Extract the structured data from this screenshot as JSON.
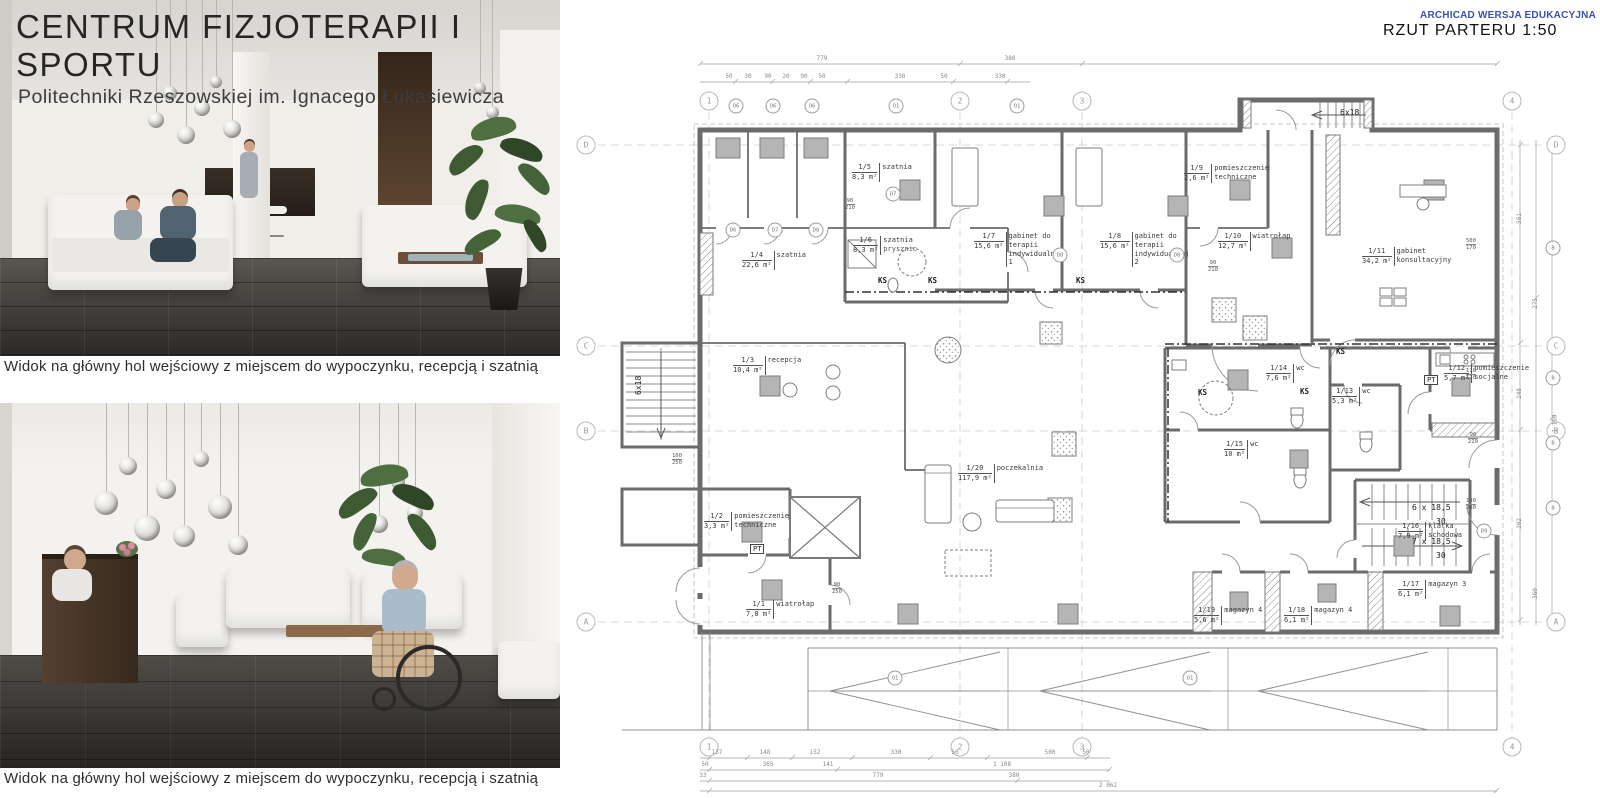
{
  "board": {
    "title": "CENTRUM  FIZJOTERAPII I SPORTU",
    "subtitle": "Politechniki Rzeszowskiej im. Ignacego Łukasiewicza",
    "caption_top": "Widok  na główny hol  wejściowy z miejscem do wypoczynku, recepcją i szatnią",
    "caption_bottom": "Widok na główny hol wejściowy z miejscem do wypoczynku, recepcją i szatnią"
  },
  "plan": {
    "watermark": "ARCHICAD WERSJA EDUKACYJNA",
    "accent_blue": "#3d52a5",
    "title": "RZUT PARTERU 1:50",
    "room_sub": "prysznic",
    "rooms": [
      {
        "id": "1/1",
        "area": "7,8 m²",
        "name": "wiatrołap"
      },
      {
        "id": "1/2",
        "area": "3,3 m²",
        "name": "pomieszczenie techniczne"
      },
      {
        "id": "1/3",
        "area": "10,4 m²",
        "name": "recepcja"
      },
      {
        "id": "1/4",
        "area": "22,6 m²",
        "name": "szatnia"
      },
      {
        "id": "1/5",
        "area": "8,3 m²",
        "name": "szatnia"
      },
      {
        "id": "1/6",
        "area": "8,3 m²",
        "name": "szatnia"
      },
      {
        "id": "1/7",
        "area": "15,6 m²",
        "name": "gabinet do terapii indywidualnej 1"
      },
      {
        "id": "1/8",
        "area": "15,6 m²",
        "name": "gabinet do terapii indywidualnej 2"
      },
      {
        "id": "1/9",
        "area": "2,6 m²",
        "name": "pomieszczenie techniczne"
      },
      {
        "id": "1/10",
        "area": "12,7 m²",
        "name": "wiatrołap"
      },
      {
        "id": "1/11",
        "area": "34,2 m²",
        "name": "gabinet konsultacyjny"
      },
      {
        "id": "1/12",
        "area": "5,7 m²",
        "name": "pomieszczenie socjalne"
      },
      {
        "id": "1/13",
        "area": "5,3 m²",
        "name": "wc"
      },
      {
        "id": "1/14",
        "area": "7,6 m²",
        "name": "wc"
      },
      {
        "id": "1/15",
        "area": "10 m²",
        "name": "wc"
      },
      {
        "id": "1/16",
        "area": "7,9 m²",
        "name": "klatka schodowa"
      },
      {
        "id": "1/17",
        "area": "6,1 m²",
        "name": "magazyn 3"
      },
      {
        "id": "1/18",
        "area": "6,1 m²",
        "name": "magazyn 4"
      },
      {
        "id": "1/19",
        "area": "5,6 m²",
        "name": "magazyn 4"
      },
      {
        "id": "1/20",
        "area": "117,9 m²",
        "name": "poczekalnia"
      }
    ],
    "grid_cols": [
      "1",
      "2",
      "3",
      "4"
    ],
    "grid_rows": [
      "D",
      "C",
      "B",
      "A"
    ],
    "stairs": {
      "left": "6x18",
      "top": "6x18",
      "upper": "6 x 18,5",
      "lower": "7 x 18,5",
      "risers": "30"
    },
    "marks": {
      "ks": "KS",
      "pt": "PT"
    },
    "tags": {
      "o1": "O1",
      "o6": "O6",
      "d6": "D6",
      "d7": "D7",
      "d8": "D8",
      "b": "B",
      "d9": "D9"
    },
    "dim_pairs": [
      [
        "90",
        "210"
      ],
      [
        "100",
        "250"
      ],
      [
        "90",
        "250"
      ],
      [
        "500",
        "170"
      ],
      [
        "170",
        "170"
      ],
      [
        "140",
        "200"
      ]
    ],
    "dims_top": [
      "779",
      "380",
      "50",
      "30",
      "90",
      "20",
      "90",
      "50",
      "330",
      "50",
      "330"
    ],
    "dims_bottom_r1": [
      "137",
      "148",
      "152",
      "330",
      "50",
      "500",
      "50"
    ],
    "dims_bottom_r2": [
      "50",
      "365",
      "141",
      "1 108"
    ],
    "dims_bottom_r3": [
      "33",
      "779",
      "380"
    ],
    "dims_bottom_r4": [
      "2 062"
    ],
    "dims_right": [
      "581",
      "248",
      "275",
      "202",
      "360",
      "1 160"
    ]
  }
}
